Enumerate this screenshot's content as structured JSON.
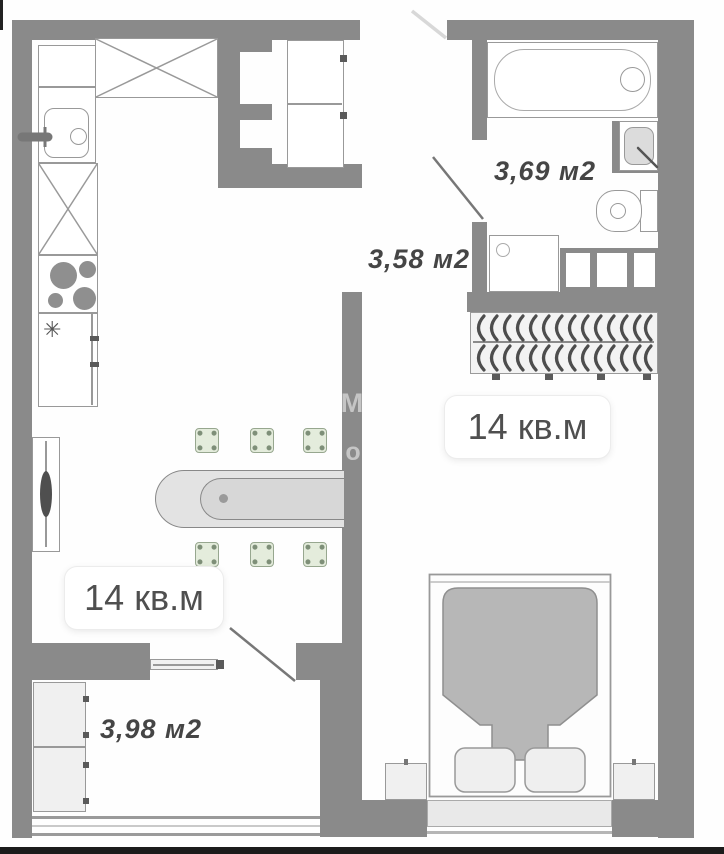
{
  "labels": {
    "living": "14 кв.м",
    "bedroom": "14 кв.м",
    "bathroom": "3,69 м2",
    "hallway": "3,58 м2",
    "balcony": "3,98 м2"
  },
  "watermark": {
    "m": "М",
    "o": "о"
  },
  "icons": {
    "freezer": "✳"
  },
  "fixtures": [
    "bathtub",
    "wash-basin",
    "toilet",
    "washing-machine",
    "wardrobe-hangers",
    "double-bed",
    "pillow",
    "nightstand",
    "dining-table",
    "chair",
    "kitchen-sink",
    "stove",
    "refrigerator",
    "tall-cabinet",
    "built-in-wardrobe",
    "radiator",
    "balcony-cabinet",
    "sliding-balcony-door",
    "door-leaf",
    "window"
  ],
  "colors": {
    "wall": "#8a8a8a",
    "fixture_outline": "#999999",
    "chair_fill": "#e4ecdc",
    "chair_border": "#97a78f",
    "blanket": "#b7b7b7",
    "table_fill": "#e3e3e3",
    "closet_fill": "#f3f3f3",
    "label_text": "#454545"
  }
}
